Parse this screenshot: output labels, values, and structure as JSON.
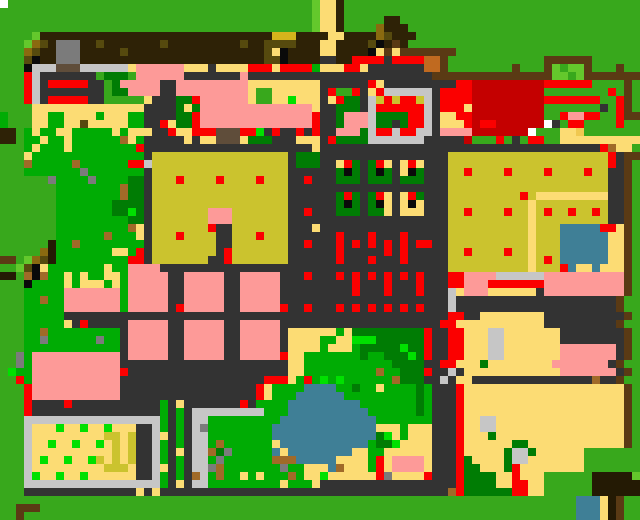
{
  "map": {
    "width": 640,
    "height": 520,
    "cell_size": 8,
    "cols": 80,
    "rows": 65,
    "palette": {
      "G": "#38a81c",
      "C": "#00ac04",
      "L": "#64c82c",
      "M": "#00e000",
      "g": "#007c04",
      "B": "#2e2206",
      "A": "#241a04",
      "O": "#564a0e",
      "o": "#a06a28",
      "d": "#8a6a10",
      "N": "#5a3a14",
      "n": "#5f4d3a",
      "c": "#c06a20",
      "D": "#333333",
      "S": "#c6c6c6",
      "Y": "#7b7b7b",
      "R": "#fb0000",
      "r": "#c40000",
      "P": "#fd9a98",
      "T": "#fcdc74",
      "F": "#f0c850",
      "K": "#cbc32e",
      "y": "#d4b41c",
      "U": "#3f7f96",
      "W": "#ffffff",
      "b": "#0a0a0a"
    },
    "grid": [
      "WGGGGGGGGGGGGGGGGGGGGGGGGGGGGGGGGGGGGGGLTTBGGGGGGGGGGGGGGGGGGGGGGGGGGGGGGGGGGGG",
      "GGGGGGGGGGGGGGGGGGGGGGGGGGGGGGGGGGGGGGGLTTBGGGGGGGGGGGGGGGGGGGGGGGGGGGGGGGGGGGG",
      "GGGGGGGGGGGGGGGGGGGGGGGGGGGGGGGGGGGGGGGLTTBGGGGGBBGGGGGGGGGGGGGGGGGGGGGGGGGGGGG",
      "GGGGGGGGGGGGGGGGGGGGGGGGGGGGGGGGGGGGGGGLTTBGGGGdBBBGGGGGGGGGGGGGGGGGGGGGGGGGGGG",
      "GGGGLBBBBBBBBBBBBBBBBBBBBBBBBBBBBByyyBBBBTTBBBBdOBBBGGGGGGGGGGGGGGGGGGGGGGGGGGGG",
      "GGGLdOBYYYBBOBBBBBBBOBBBBBBBBBOBBOOOOBBBTTBBBBObBNBGGGGGGGGGGGGGGGGGGGGGGGGGGGGG",
      "GGGdOBBYYYBBBBBOBBBBBBBBBBBBBBBBBOTbBBBBTTBBBBbTNTNNNNNNNGGGGGGGGGGGGGGGGGGGGGGG",
      "GGGObBBYYYBBBBBBBBBBBBBBBBBBBBBBBOObBBBBDDBBRRRRDRRRRccNGGGGGGGGGGGGNNNNNNGGGGGG",
      "GGGbSSSnnnSSSSSSTPPPPPPTTTDTTTTRRRTRRRRCTTTRRTDDDDDDDccNGGGGGGGGNGGGNLGLLNGGGNGG",
      "GGGRSDDDDDDDGgggGPPPPPPDDDDDDDPDDDDDDDDDDDDDDDDDDDDDDDNNNNNNNNNNNNNNNLLGLNNNNNNN",
      "GGGRSDRRRRRDDGgPPPPPDDPPPPPPPPPTTTTTTTTTDDDDDDRTDDDDDDDDDRRrrrrrrrrrRRRRRRGGGGNG",
      "GGGRSDDDDDDDDGggPPPPDDPPPPPPPPPTGGTTTTTTDRGGRDTRSSSSSSDRRRRrrrrrrrrrGGGGGGGGRGNG",
      "GGGRSDRRRRRDDGGGGGTDDDggRPPPPPPTGGTTMTTTDTRggDSKRKRRKSDRRRRrrrrrrrrrRRRRRRRGGRNG",
      "GGGGTTTTTTTTTTTTTTDDDDgTgPPPPPPPPPPPPPPTDDgggDSRRRRRRSDRRRTrrrrrrrrrGGGGGGGDGRNG",
      "CGGGTTCCTTTTCTTTCCDDDDggRPPPPPPPPPPPPPPRDDgPPPSggggRRSDTTRRrrrrrrrrrGGRPPRRGGRNN",
      "CGGGTTCCTTOTTTTTCCDDRTggRPPPPPPPPPPPPPPRDDgPPPSggDgRRSDTTTRrRRrrrrrrWDGRRGGGGRGG",
      "BBGCTCCTTCCCCCTCTTTDDRTTRRRnnnRRMDRDDRDRDDPPPgSRRSRRSSDPPPPrrrrrrrWGGGTTFGGGGGGG",
      "BBGCCTCCTCCCCCCoTCDDDDDTDTTnnnTgggDDDTTTDRggggSSSSSSSDDDDDrGGGRGDGRRGGTTTTTTTTTT",
      "GGGCTCCCTCCCCCCCCRDDDDDDDDDDDDDDDDDDDDDTDDDDDDDDDDDDDDDDDDDDDDDDDDDDDDDDDDDRoTT",
      "GGGTCCCCCCCCCCCCCCDKKKKKKKKKKKKKKKKKDgggDDDDDDDDDDDDDDDDKKKKKKKKKKKKKKKKKKKKRDNN",
      "GGGoCCCCCoCCCCCCRRSKKKKKKKKKKKKKKKKKDgggDDTRgDgRTDTRTDDDKKKKKKKKKKKKKKKKKKKKRDNG",
      "GGGCCCCCCCYCCCCCCCDKKKKKKKKKKKKKKKKKDDDDDDgbgDgbgDTbgDDDKKRKKKKRKKKKRKKKKRKKDDNG",
      "GGGGGGYCCCCYCCCCggDKKKRKKKKRKKKKRKKKDDRDDDgggDgggDgggDDDKKKKKKKKKKKKKKKKKKKKDDNG",
      "GGGGGGGCCCCCCCCoggDKKKKKKKKKKKKKKKKKDDDDDDDDDDDDDDDDDDDDKKKKKKKKKKKKKKKKKKKKDDNG",
      "GGGGGGGCCCCCCCCoggDKKKKKKKKKKKKKKKKKDDDDDDgRgDgRTDTRgDDDKKKKKKKKKRKTTTTTTTTTDDNG",
      "GGGGGGGCCCCCCCggggDKKKKKKKKKKKKKKKKKDDDDDDgbgDgbTDTbTDDDKKKKKKKKKKTKKKKKKKKKDDNG",
      "GGGGGGGCCCCCCCggMgDKKKKKKKPPPKKKKKKKDDRDDDgggDggTDTTTDDDKKRKKKKRKKTKRKKRKKRKDDNG",
      "GGGGGGGCCCCCCCCCggDKKKKKKKPPPKKKKKKKDDDDDDDDDDDDDDDDDDDDKKKKKKKKKKTKKKKKKKKKDDNG",
      "GGGGGGGCCCCCCCCCoTDKKKKKKKRDDKKKKKKKDDDTDDDDDDDDDDDDDDDDKKKKKKKKKKTKKKUUUUURRTNG",
      "GGGGGGGCCCCCCoCCCTDKKKRKKKKDDKKKRKKKDDDDDDRDDDRDDDRDDDDDKKKKKKKKKKTKKKUUUUUUTTNG",
      "GGGGGGACCoCCCCCCCCDKKKKKKKKDDKKKKKKKDDRDDDRDRDRDRDRDRRDDKKKKKKKKKKTKKKUUUUUUTTNG",
      "GGGGGdACCCCCCCTTCRDKKKKKKKKDRKKKKKKKDDDDDDRDDDDDRDRDDDDDKKRKKKKRKKTKKKUUUUUUTTNG",
      "NNGLdOACCCCCCCCCRRDKKKKKKKDDRKKKKKKKDDDDDDRDDDRDDDRDDDDDKKKKKKKKKKTKRKUUUUUUTTNG",
      "GGLObTCCCCCCCTCCPPPPDDDDDDDDDDDDDDDDDDDDDDDDDDDDDDDDDDDDKKKKKKKKKKTKKKRUTTUTTTNG",
      "AAGoboCCTCTCCTTCPPPPPDDPPPPPDDPPPPPDDDRDDDRDRDRDRDRDRDDDRRPPPPSSSSSSPPPPPPPPPPNG",
      "GGGbCCCCTCTTTCTCPPPPPDDPPPPPDDPPPPPDDDDDDDDDRDDDRDDDRDDDRRPPPRRRRRRRPPPPPPPPPPNG",
      "GGGCCCCCPPPPPPPCPPPPPDDPPPPPDDPPPPPDDDDDDDDDRDDDRDDDRDDDSTPPPTTTTTTDPPPPPPPPPPNG",
      "GGGCCoCCPPPPPPPCPPPPPDDPPPPPDDPPPPPDDDDDDDDDDDDDDDDDDDDDSDDDDDDDDDDDDDDDDDDDDNG",
      "GGGCCCCCPPPPPPPCPPPPPDRPPPPPDDPPPPPRDDRDDDRDRDRDRDRDRDDDSDDDDDDDDDDDDDDDDDDDDNG",
      "GGGCCCCCDDDDDDDDDDDDDDDDDDDDDDDDDDDDDDDDDDDDDDDDDDDDDDDDRRDDTTTTTTTTDDDDDDDDDDNG",
      "GGGCCCCCTDRDDDDDPPPPPDDPPPPPDDPPPPPDDDDDDDDDDDDDDDDDDDDRRTTTTTTTTTTTDDDDDDDDDNG",
      "GGGCCoCCCCCCCCCDPPPPPDDPPPPPDDPPPPPDTTTTTTCTgggggggggRDDRRTTTSSTTTTTTTDDDDDDDDNG",
      "GGGCCYCCCCCCYCCDPPPPPDDPPPPPDDPPPPPDTTTTCCTTMMMggggggRDDRRTTTSSTTTTTTTDDDDDDDDNG",
      "GGGCCCCCCCCCCCCDPPPPPDDPPPPPDDPPPPPDTTTTCTTTCgggggMggRDDRRTTTSSTTTTTTTPPPPPPPDNG",
      "GGYCPPPPPPPPPPPDPPPPPDDPPPPPDDPPPPPRTTCCCCCCCgCCgggMgRDDRRTTTSSTTTTTTTPPPPPPPDNG",
      "GGYCPPPPPPPPPPPDDDDDDDDDDDDDDDDDDDDDTTCCCCCCCCCCCggggDDRRTTTgTTTTTTTTPPPPPPPDNG",
      "GMCCPPPPPPPPPPPRDDDDDDDDDDDDDDDDDDDDTTCCCCCCCCCoCCgggRDDSDTTTTTTTTTTTTPPPPPPPDNG",
      "GGRCPPPPPPPPPPPDDDDDDDDDDDDDDDDDDRRRTCRCMCMCCCCCCogggDDSDTTDDDDDDDDDDDDDDDoDDNG",
      "GGGRPPPPPPPPPPPDDDDDDDDDDDDDDDDDRTCCCCUUUUCCgCCTCCCCgCDDDRTTTTTTTTTTTTTTTTTTTTNG",
      "GGGRPPPPPPPPPPPDDDDDDDDDDDDDDDDDRTCCCUUUUUUCCCCCCCCCgCDDDRTTTTTTTTTTTTTTTTTTTTNG",
      "GGGRDDDDRDDDDDDDDDDDCDTDDDDDDDRDCCCCUUUUUUUUUCCCCCCCgCDDDRTTTTTTTTTTTTTTTTTTTTNG",
      "GGGRDDDDDDDDDDDDDDDDCDCDSSSSSSSSSCCCUUUUUUUUUUCCCCCCgCDDDRTTTTTTTTTTTTTTTTTTTTNG",
      "GGGSSSSSSSSSSSSSSSSSCDCDSSCCCCCCCCCUUUUUUUUUUUUCCCCCCCDDDRTTSSTTTTTTTTTTTTTTTTNG",
      "GGGSTTTMTTMTTMTTTDDSCDCDSYCCCCCCCCUUUUUUUUUUUUUTTTCTTTDDDRTTSSTTTTTTTTTTTTTTTTNG",
      "GGGSTTTTTTTTTKKTKDDSTDCDSSCCCCCCCCUUUUUUUUUUUUUgMTCTTTDDDRTTTgTTTTTTTTTTTTTTTTNG",
      "GGGSTTMTTMTTMTKTKDDSCDCDSSCoCCCCCCTUUUUUUUUUUUCggMTTTTDDDRTTTTTTggTTTTTTTTTTTTNG",
      "GGGSTTTTTTTTTTKTKDDSCDTDSSogYCCCCCUTUUUUUUUUTTCCTTTTTTDDDRTTTTTgSSgTTTTTTGGGGGGG",
      "GGGSTMTTMTTMKTKTKDDSCDCDSSCYCCCCCCoooUUUUUTTTTCRTPPPPTDDDRgTTTTgSSTTTTTTTGGGGGGG",
      "GGGSTTTTTTTTTKKKTDDSTDCDSSYoCCCCCCCYCCTTTUoTTTCRTPPPPTDDDRggTTTgRTTTTTTTTGGGGGGG",
      "GGGSMTTMTTMTTTTTTDDSCDCDoSCoCCTCTCCCoCTTMTTTTTTRYTTTTRDDDRggggTTRTTTGGGGGGAAAAAL",
      "GGGSSSSSSSSSSSSSSSSSCDTDSSCCCCCCCCCTCCCTDDDDDDDDDDDDDDDDDRggggTTRRTTGGGGGGAAAAAA",
      "GGGDDDDDDDDDDDDDDTDTDDDDDDDDDDDDDDDDDDDDDDDDDDDDDDDDDDDDoRggggggRRTTGGGGGGAAAAAA",
      "GGGGGGGGGGGGGGGGGGGGGGGGGGGGGGGGGGGGGGGGGGGGGGGGGGGGGGGGGGGGGGGGGGGGGGGGUUUTAN",
      "GGNNNGGGGGGGGGGGGGGGGGGGGGGGGGGGGGGGGGGGGGGGGGGGGGGGGGGGGGGGGGGGGGGGGGGGUUUTAN",
      "GGNGGGGGGGGGGGGGGGGGGGGGGGGGGGGGGGGGGGGGGGGGGGGGGGGGGGGGGGGGGGGGGGGGGGGGUUUTAN"
    ]
  }
}
